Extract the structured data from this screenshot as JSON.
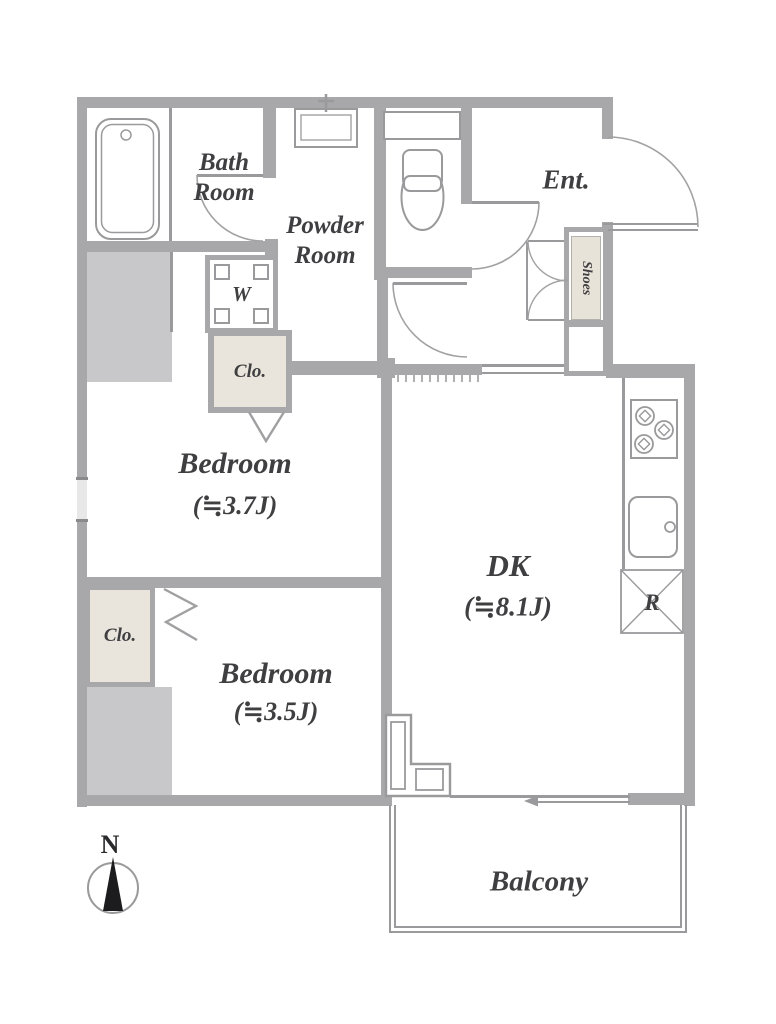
{
  "rooms": {
    "bath": {
      "label": "Bath Room"
    },
    "powder": {
      "label": "Powder Room"
    },
    "entrance": {
      "label": "Ent."
    },
    "shoes_cabinet": {
      "label": "Shoes"
    },
    "washer": {
      "label": "W"
    },
    "closet_upper": {
      "label": "Clo."
    },
    "closet_lower": {
      "label": "Clo."
    },
    "bedroom_1": {
      "label": "Bedroom",
      "size": "(≒3.7J)"
    },
    "bedroom_2": {
      "label": "Bedroom",
      "size": "(≒3.5J)"
    },
    "dining_kitchen": {
      "label": "DK",
      "size": "(≒8.1J)"
    },
    "refrigerator_space": {
      "label": "R"
    },
    "balcony": {
      "label": "Balcony"
    }
  },
  "compass": {
    "north": "N"
  },
  "colors": {
    "wall": "#a8a8aa",
    "shaded_area": "#c8c8ca",
    "closet_fill": "#eae5dc",
    "outline": "#9a9a9c",
    "text": "#3f3f41",
    "compass_needle": "#1c1c1e"
  }
}
